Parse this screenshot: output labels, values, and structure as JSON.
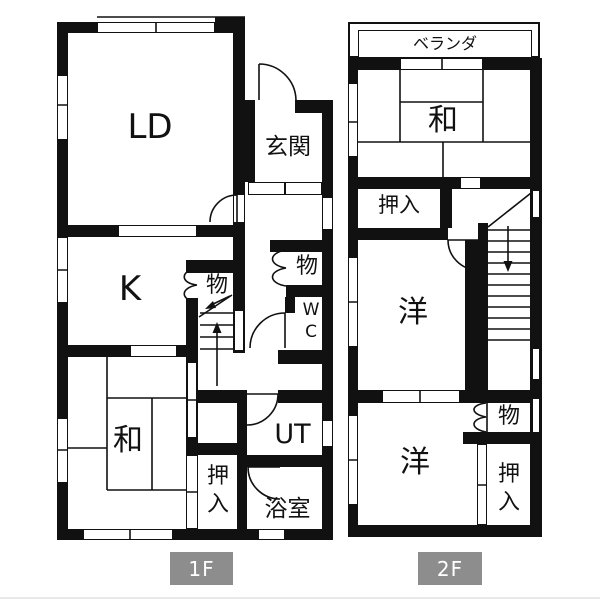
{
  "f1": {
    "badge": "1F",
    "rooms": {
      "ld": "LD",
      "genkan": "玄関",
      "kitchen": "K",
      "storage_a": "物",
      "storage_b": "物",
      "wc": "WC",
      "washitsu": "和",
      "oshiire": "押入",
      "utility": "UT",
      "bathroom": "浴室"
    }
  },
  "f2": {
    "badge": "2F",
    "rooms": {
      "veranda": "ベランダ",
      "washitsu": "和",
      "oshiire_upper": "押入",
      "western_1": "洋",
      "western_2": "洋",
      "storage": "物",
      "oshiire_lower": "押入"
    }
  },
  "colors": {
    "wall": "#111111",
    "badge_bg": "#8d8d8d",
    "badge_text": "#ffffff",
    "background": "#ffffff"
  }
}
